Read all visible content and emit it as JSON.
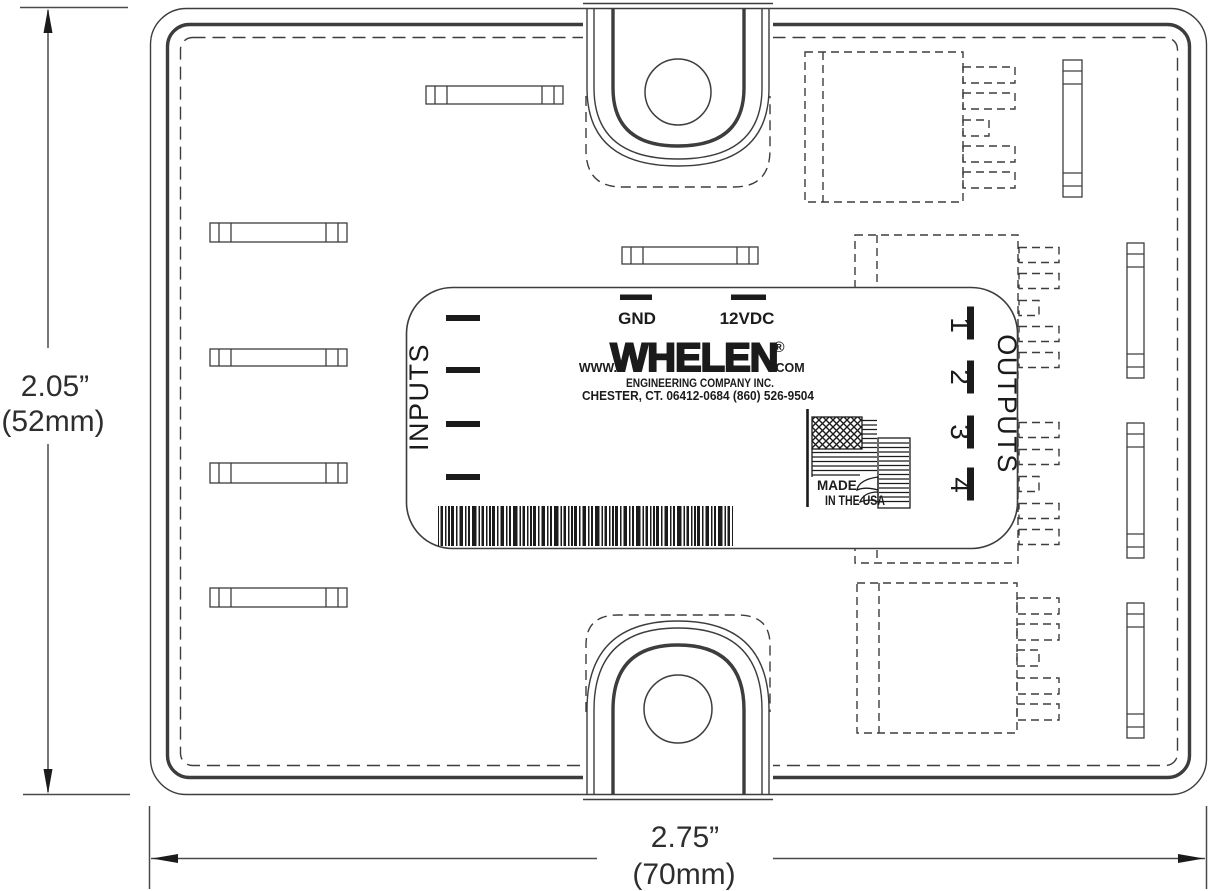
{
  "page": {
    "background": "#ffffff",
    "line_color": "#3d3d3d",
    "label_ink_color": "#1b1b1b"
  },
  "dimensions": {
    "height_in": "2.05”",
    "height_mm": "(52mm)",
    "width_in": "2.75”",
    "width_mm": "(70mm)"
  },
  "label": {
    "inputs_title": "INPUTS",
    "outputs_title": "OUTPUTS",
    "terminal_gnd": "GND",
    "terminal_12vdc": "12VDC",
    "url_prefix": "WWW.",
    "brand": "WHELEN",
    "registered_mark": "®",
    "url_suffix": ".COM",
    "company_line": "ENGINEERING COMPANY INC.",
    "address_line": "CHESTER, CT. 06412-0684 (860) 526-9504",
    "made_line1": "MADE",
    "made_line2": "IN THE USA",
    "output_numbers": [
      "1",
      "2",
      "3",
      "4"
    ]
  }
}
